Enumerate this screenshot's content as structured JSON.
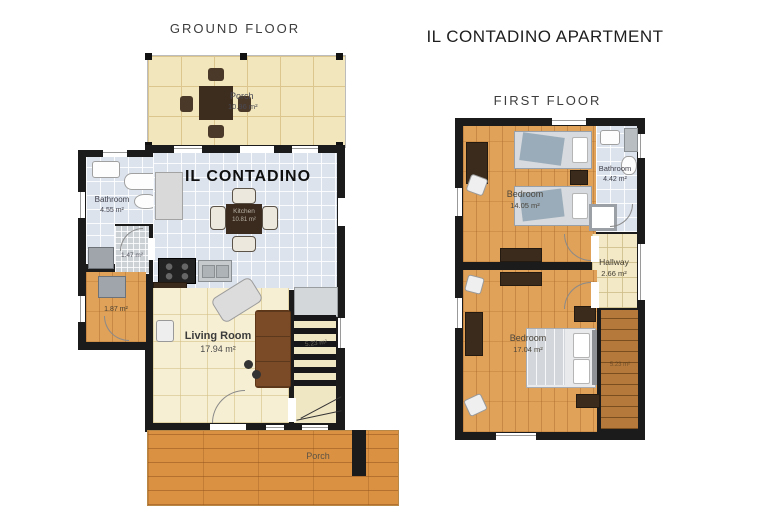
{
  "header": {
    "apartment_title": "IL CONTADINO APARTMENT"
  },
  "ground_floor": {
    "heading": "GROUND FLOOR",
    "brand": "IL CONTADINO",
    "porch_top": {
      "name": "Porch",
      "area": "10.96 m²"
    },
    "bathroom": {
      "name": "Bathroom",
      "area": "4.55 m²"
    },
    "wc": {
      "area": "1.47 m²"
    },
    "kitchen": {
      "name": "Kitchen",
      "area": "10.81 m²"
    },
    "living_room": {
      "name": "Living Room",
      "area": "17.94 m²"
    },
    "stairs": {
      "area": "5.23 m²"
    },
    "entry": {
      "area": "1.87 m²"
    },
    "porch_bottom": {
      "name": "Porch"
    }
  },
  "first_floor": {
    "heading": "FIRST FLOOR",
    "bedroom_top": {
      "name": "Bedroom",
      "area": "14.05 m²"
    },
    "bathroom": {
      "name": "Bathroom",
      "area": "4.42 m²"
    },
    "hallway": {
      "name": "Hallway",
      "area": "2.66 m²"
    },
    "bedroom_bottom": {
      "name": "Bedroom",
      "area": "17.04 m²"
    },
    "stairs": {
      "area": "5.23 m²"
    }
  },
  "colors": {
    "wall": "#1b1b1b",
    "tile_blue": "#dce3ed",
    "tile_cream": "#f2e6bc",
    "floor_cream": "#f7efd3",
    "wood": "#e0a158",
    "deck_orange": "#db9142",
    "sofa_brown": "#7b4a26"
  }
}
